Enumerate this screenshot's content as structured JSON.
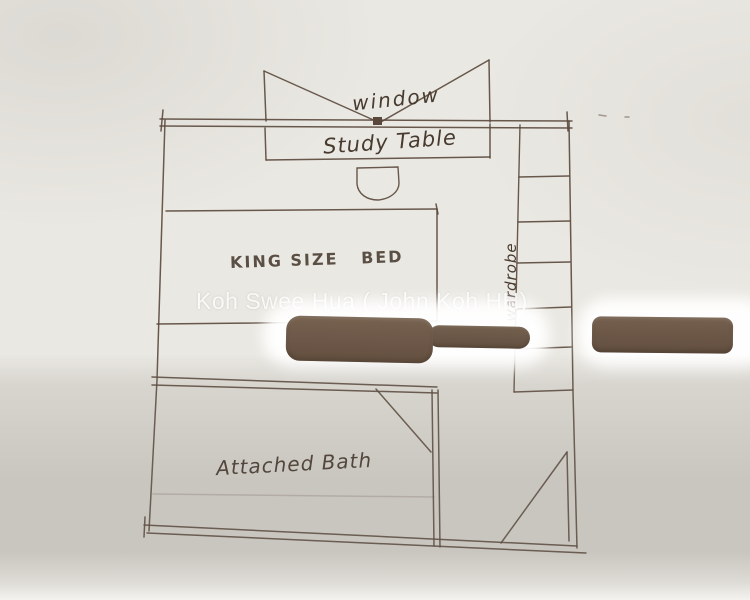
{
  "labels": {
    "window": "window",
    "study_table": "Study Table",
    "king_bed": "KING SIZE   BED",
    "wardrobe": "wardrobe",
    "attached_bath": "Attached Bath"
  },
  "watermark": {
    "text": "Koh Swee Hua ( John Koh HH)"
  },
  "colors": {
    "paper": "#eae8e2",
    "ink": "#5a483c",
    "handwriting_ink": "#473a2f",
    "pen_brown": "#6e594a",
    "shadow_gray": "#cac7c3",
    "glare_white": "#ffffff"
  }
}
